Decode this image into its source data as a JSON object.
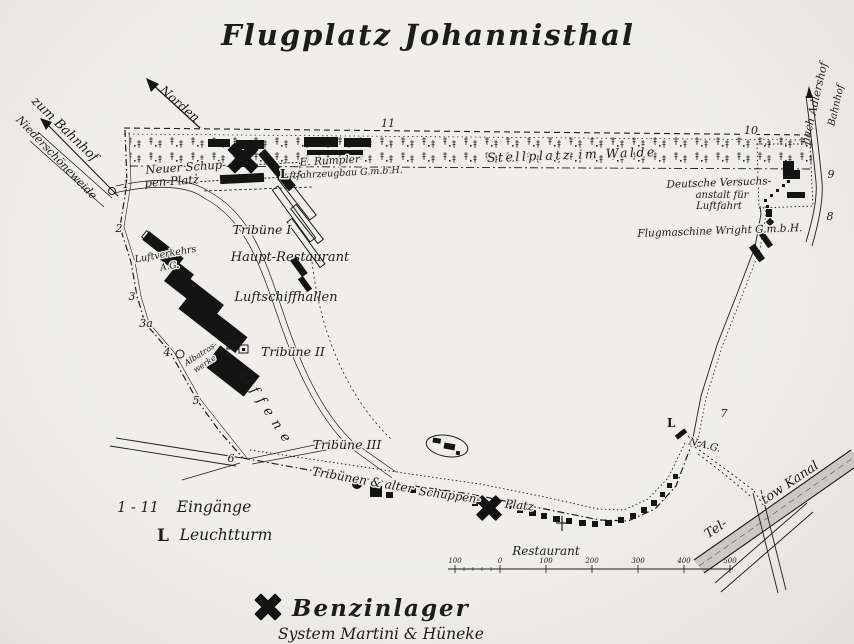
{
  "title": "Flugplatz Johannisthal",
  "colors": {
    "paper": "#e9e7e2",
    "ink": "#1c1c1c"
  },
  "map": {
    "labels": {
      "norden": "Norden",
      "zum_bahnhof": "zum Bahnhof",
      "niederschoeneweide": "Niederschöneweide",
      "nach_adlershof": "nach Adlershof",
      "adlershof_bahnhof": "Bahnhof",
      "neuer_schuppen_1": "Neuer Schup-",
      "neuer_schuppen_2": "pen-Platz",
      "rumpler_1": "E. Rumpler",
      "rumpler_2": "Luftfahrzeugbau G.m.b.H.",
      "stellplatz": "Stellplatz im Walde",
      "dvl_1": "Deutsche Versuchs-",
      "dvl_2": "anstalt für",
      "dvl_3": "Luftfahrt",
      "wright": "Flugmaschine Wright G.m.b.H.",
      "luftverkehrs_1": "Luftverkehrs",
      "luftverkehrs_2": "A.G.",
      "tribuene_1": "Tribüne I",
      "haupt_restaurant": "Haupt-Restaurant",
      "luftschiffhallen": "Luftschiffhallen",
      "albatros_1": "Albatros-",
      "albatros_2": "werke",
      "tribuene_2": "Tribüne II",
      "offene": "Offene",
      "tribuene_3": "Tribüne III",
      "tribuenen_alter": "Tribünen & alter",
      "schuppen": "Schuppen-",
      "platz": "Platz",
      "restaurant": "Restaurant",
      "nag": "N.A.G.",
      "teltow_1": "Tel-",
      "teltow_2": "tow Kanal",
      "lighthouse_nw": "L",
      "lighthouse_se": "L"
    },
    "entrances": [
      "1",
      "2",
      "3",
      "3a",
      "4",
      "5",
      "6",
      "7",
      "8",
      "9",
      "10",
      "11"
    ],
    "scale_ticks": [
      "100",
      "0",
      "100",
      "200",
      "300",
      "400",
      "500"
    ]
  },
  "legend": {
    "entrance_range": "1 - 11",
    "entrance_label": "Eingänge",
    "lighthouse_symbol": "L",
    "lighthouse_label": "Leuchtturm",
    "benzinlager_label": "Benzinlager",
    "benzinlager_system": "System Martini & Hüneke"
  }
}
